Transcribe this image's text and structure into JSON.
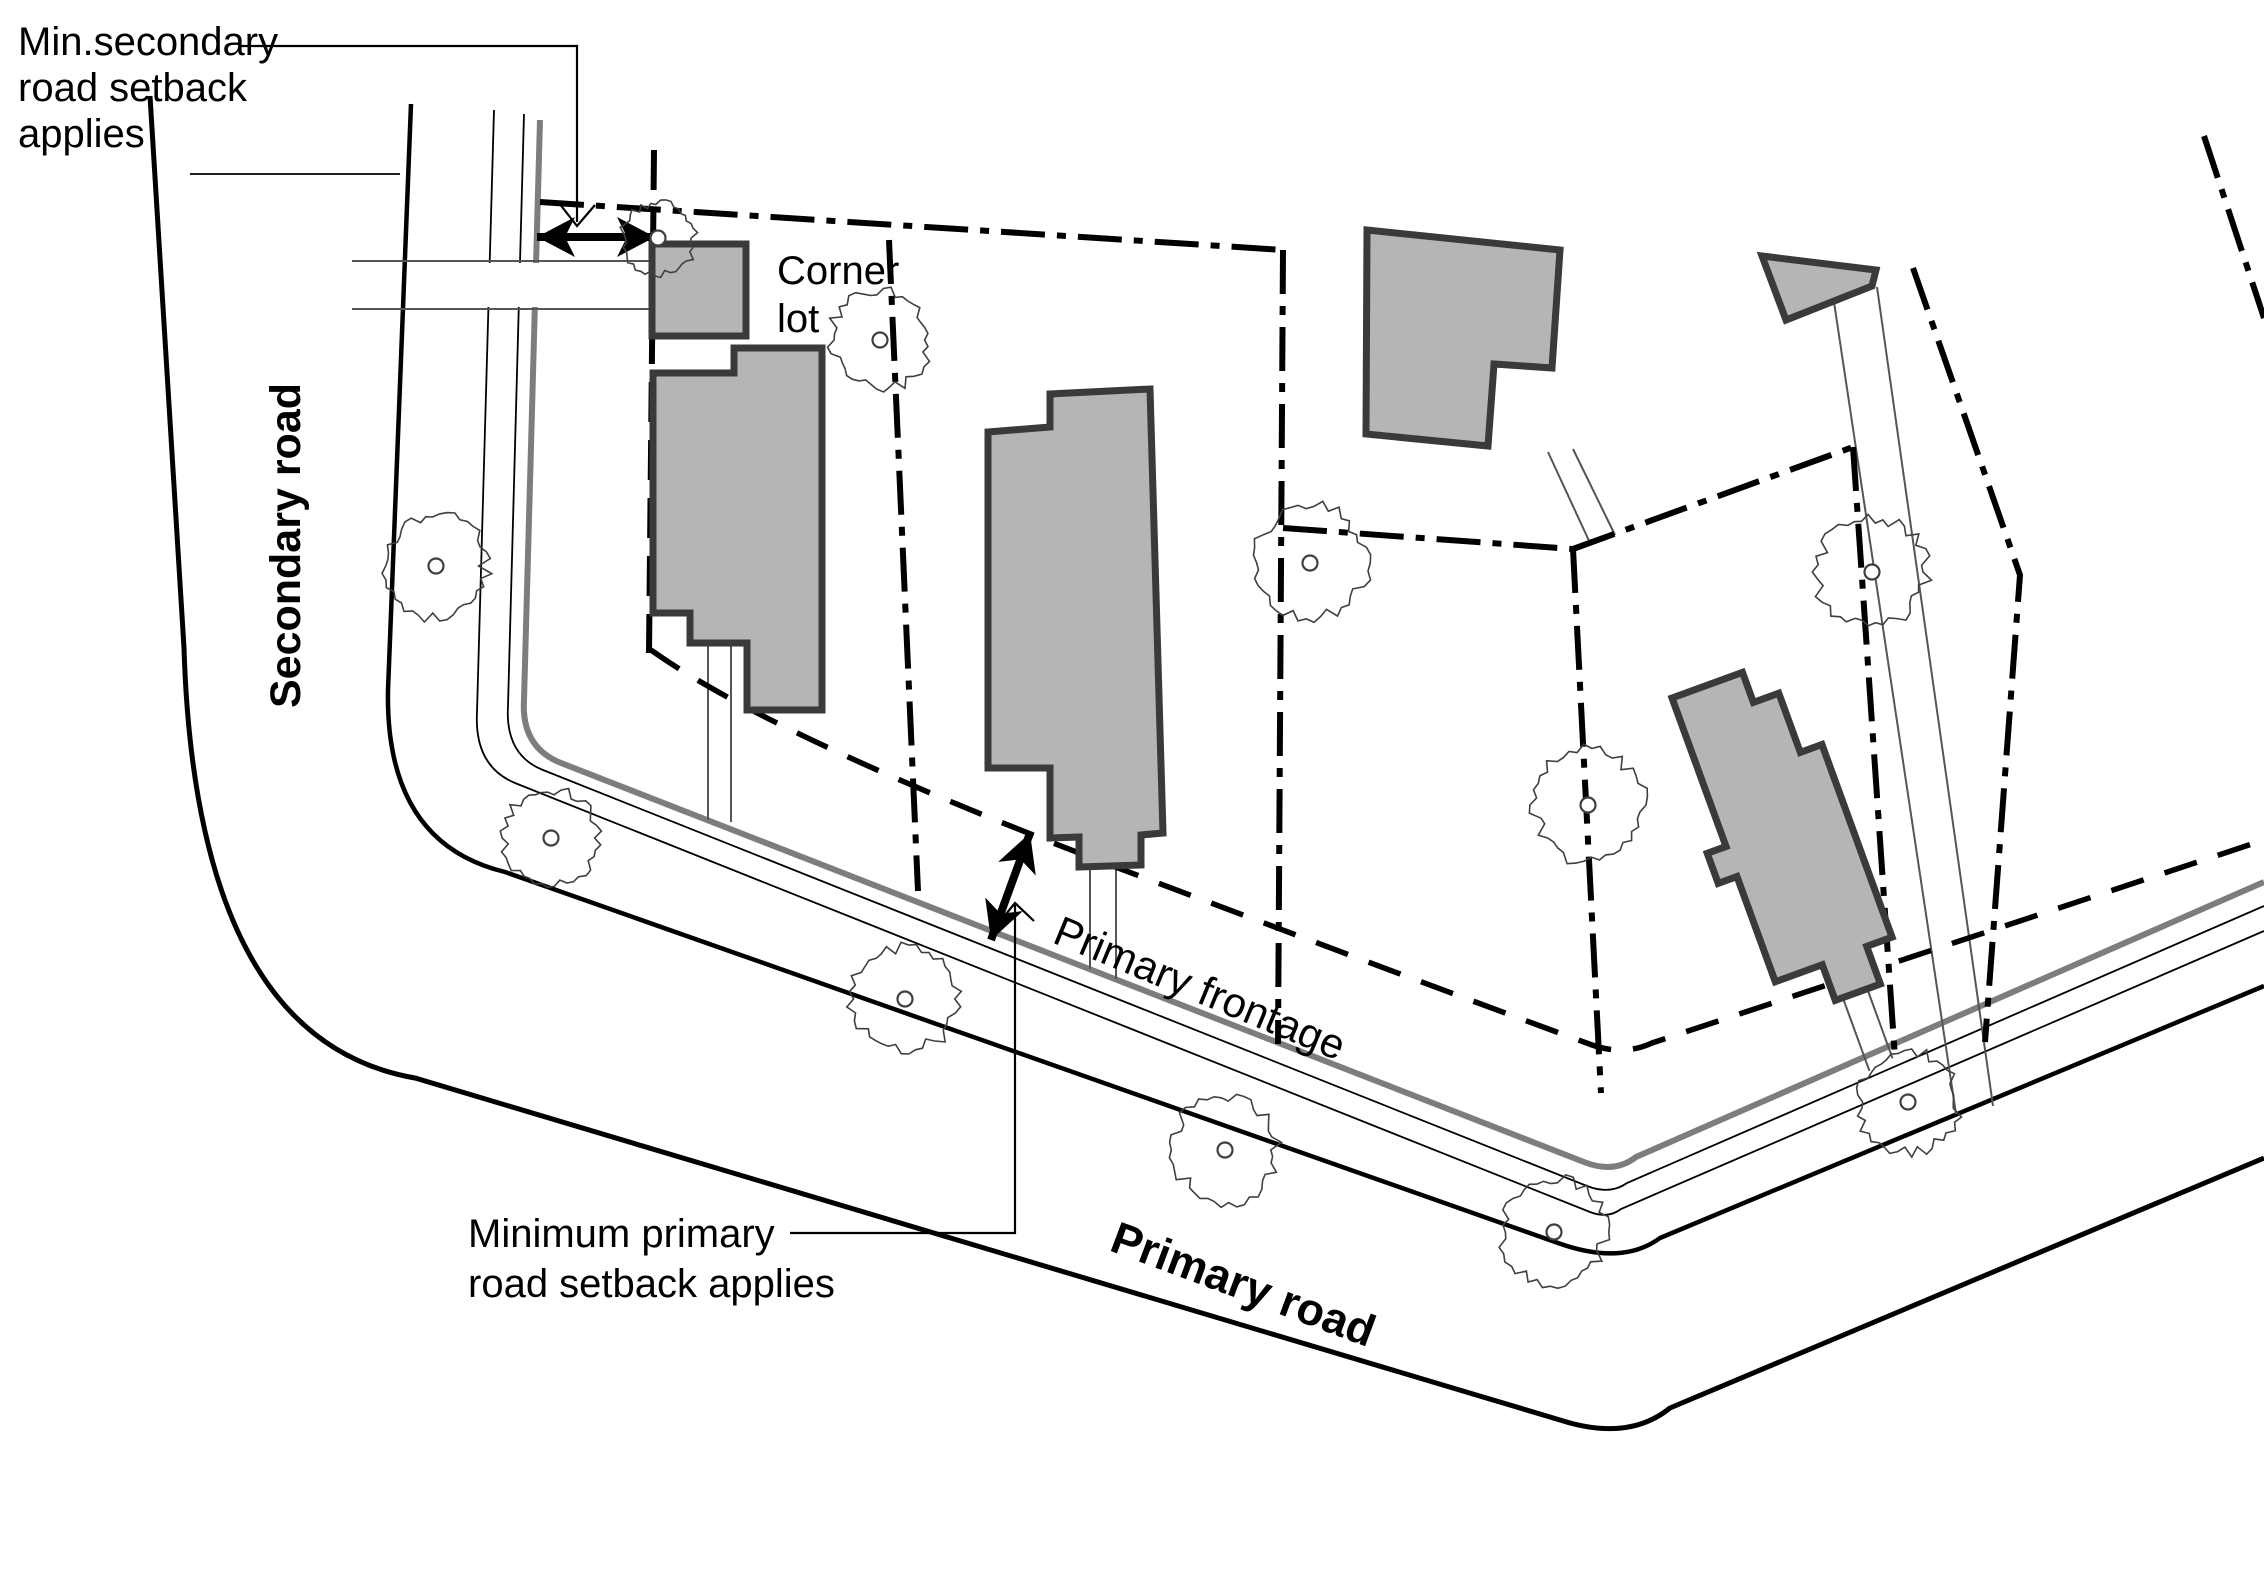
{
  "annotations": {
    "min_secondary_setback": {
      "lines": [
        "Min.secondary",
        "road setback",
        "applies"
      ]
    },
    "corner_lot": {
      "lines": [
        "Corner",
        "lot"
      ]
    },
    "min_primary_setback": {
      "lines": [
        "Minimum primary",
        "road setback applies"
      ]
    },
    "secondary_road_label": "Secondary road",
    "primary_road_label": "Primary road",
    "primary_frontage_label": "Primary frontage"
  },
  "colors": {
    "background": "#ffffff",
    "line": "#000000",
    "property_line": "#7d7d7d",
    "building_fill": "#b5b5b5",
    "building_stroke": "#3a3a3a"
  }
}
